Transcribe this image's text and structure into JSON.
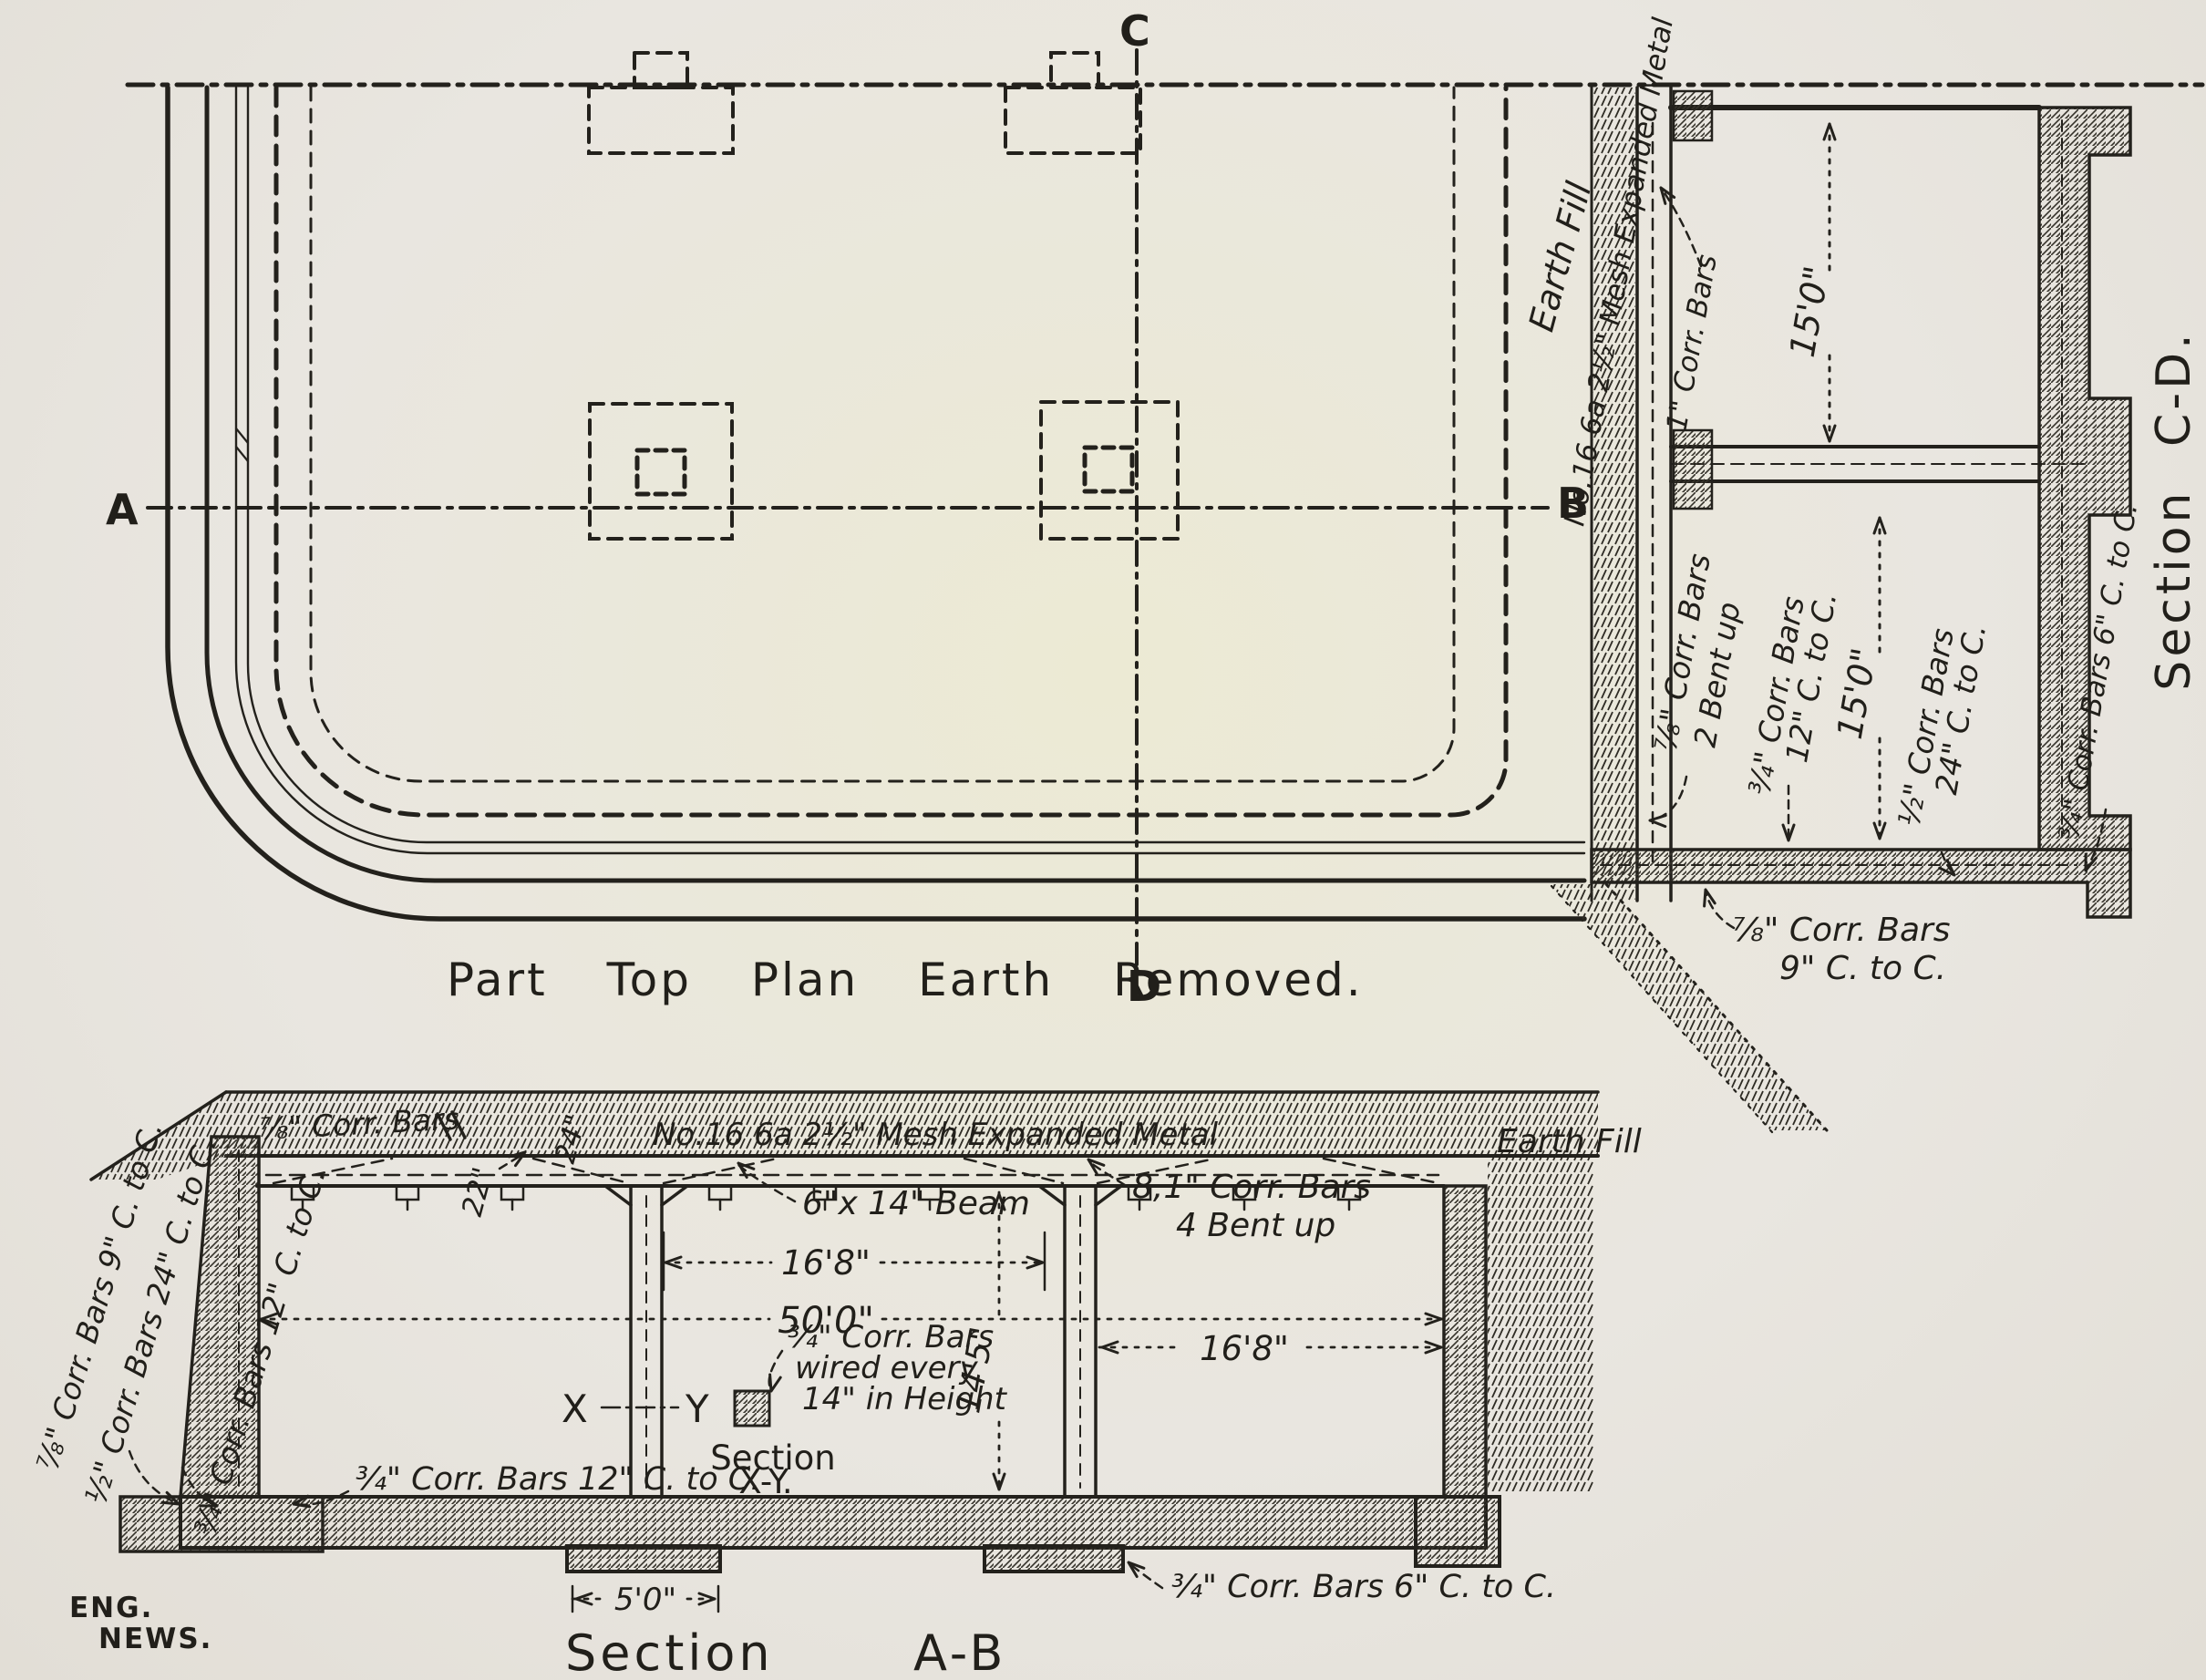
{
  "colors": {
    "paper": "#e9e6e0",
    "ink": "#23211c"
  },
  "plan": {
    "title": "Part Top Plan Earth Removed.",
    "marker_a": "A",
    "marker_b": "B",
    "marker_c": "C",
    "marker_d": "D"
  },
  "section_cd": {
    "title": "Section C-D.",
    "earth_fill": "Earth Fill",
    "mesh": "No.16 6a 2½\" Mesh Expanded Metal",
    "corr_bars_1in": "1\" Corr. Bars",
    "dim_15_top": "15'0\"",
    "dim_15_bottom": "15'0\"",
    "bars_78_bent_1": "⅞\" Corr. Bars",
    "bars_78_bent_2": "2 Bent up",
    "bars_34_12_1": "¾\" Corr. Bars",
    "bars_34_12_2": "12\" C. to C.",
    "bars_12_24_1": "½\" Corr. Bars",
    "bars_12_24_2": "24\" C. to C.",
    "bars_78_9_1": "⅞\" Corr. Bars",
    "bars_78_9_2": "9\" C. to C.",
    "bars_34_6": "¾\" Corr. Bars 6\" C. to C."
  },
  "section_ab": {
    "title_word": "Section",
    "title_ab": "A-B",
    "bars_78": "⅞\" Corr. Bars",
    "dim_24": "24\"",
    "dim_22": "22\"",
    "mesh": "No.16 6a 2½\" Mesh Expanded Metal",
    "earth_fill": "Earth Fill",
    "beam": "6\"x 14\" Beam",
    "bars_81_1": "8,1\" Corr. Bars",
    "bars_81_2": "4 Bent up",
    "dim_168_mid": "16'8\"",
    "dim_500": "50'0\"",
    "dim_145": "14'5\"",
    "dim_168_right": "16'8\"",
    "wired_1": "¾\" Corr. Bars",
    "wired_2": "wired every",
    "wired_3": "14\" in Height",
    "marker_x": "X",
    "marker_y": "Y",
    "section_xy_1": "Section",
    "section_xy_2": "X-Y.",
    "wall_bars_78_9": "⅞\" Corr. Bars 9\" C. to C.",
    "wall_bars_12_24": "½\" Corr. Bars 24\" C. to C.",
    "wall_bars_34_12": "¾\" Corr. Bars 12\" C. to C.",
    "floor_bars_34_12": "¾\" Corr. Bars 12\" C. to C.",
    "floor_bars_34_6": "¾\" Corr. Bars 6\" C. to C.",
    "dim_5ft": "5'0\"",
    "credit_1": "ENG.",
    "credit_2": "NEWS."
  }
}
